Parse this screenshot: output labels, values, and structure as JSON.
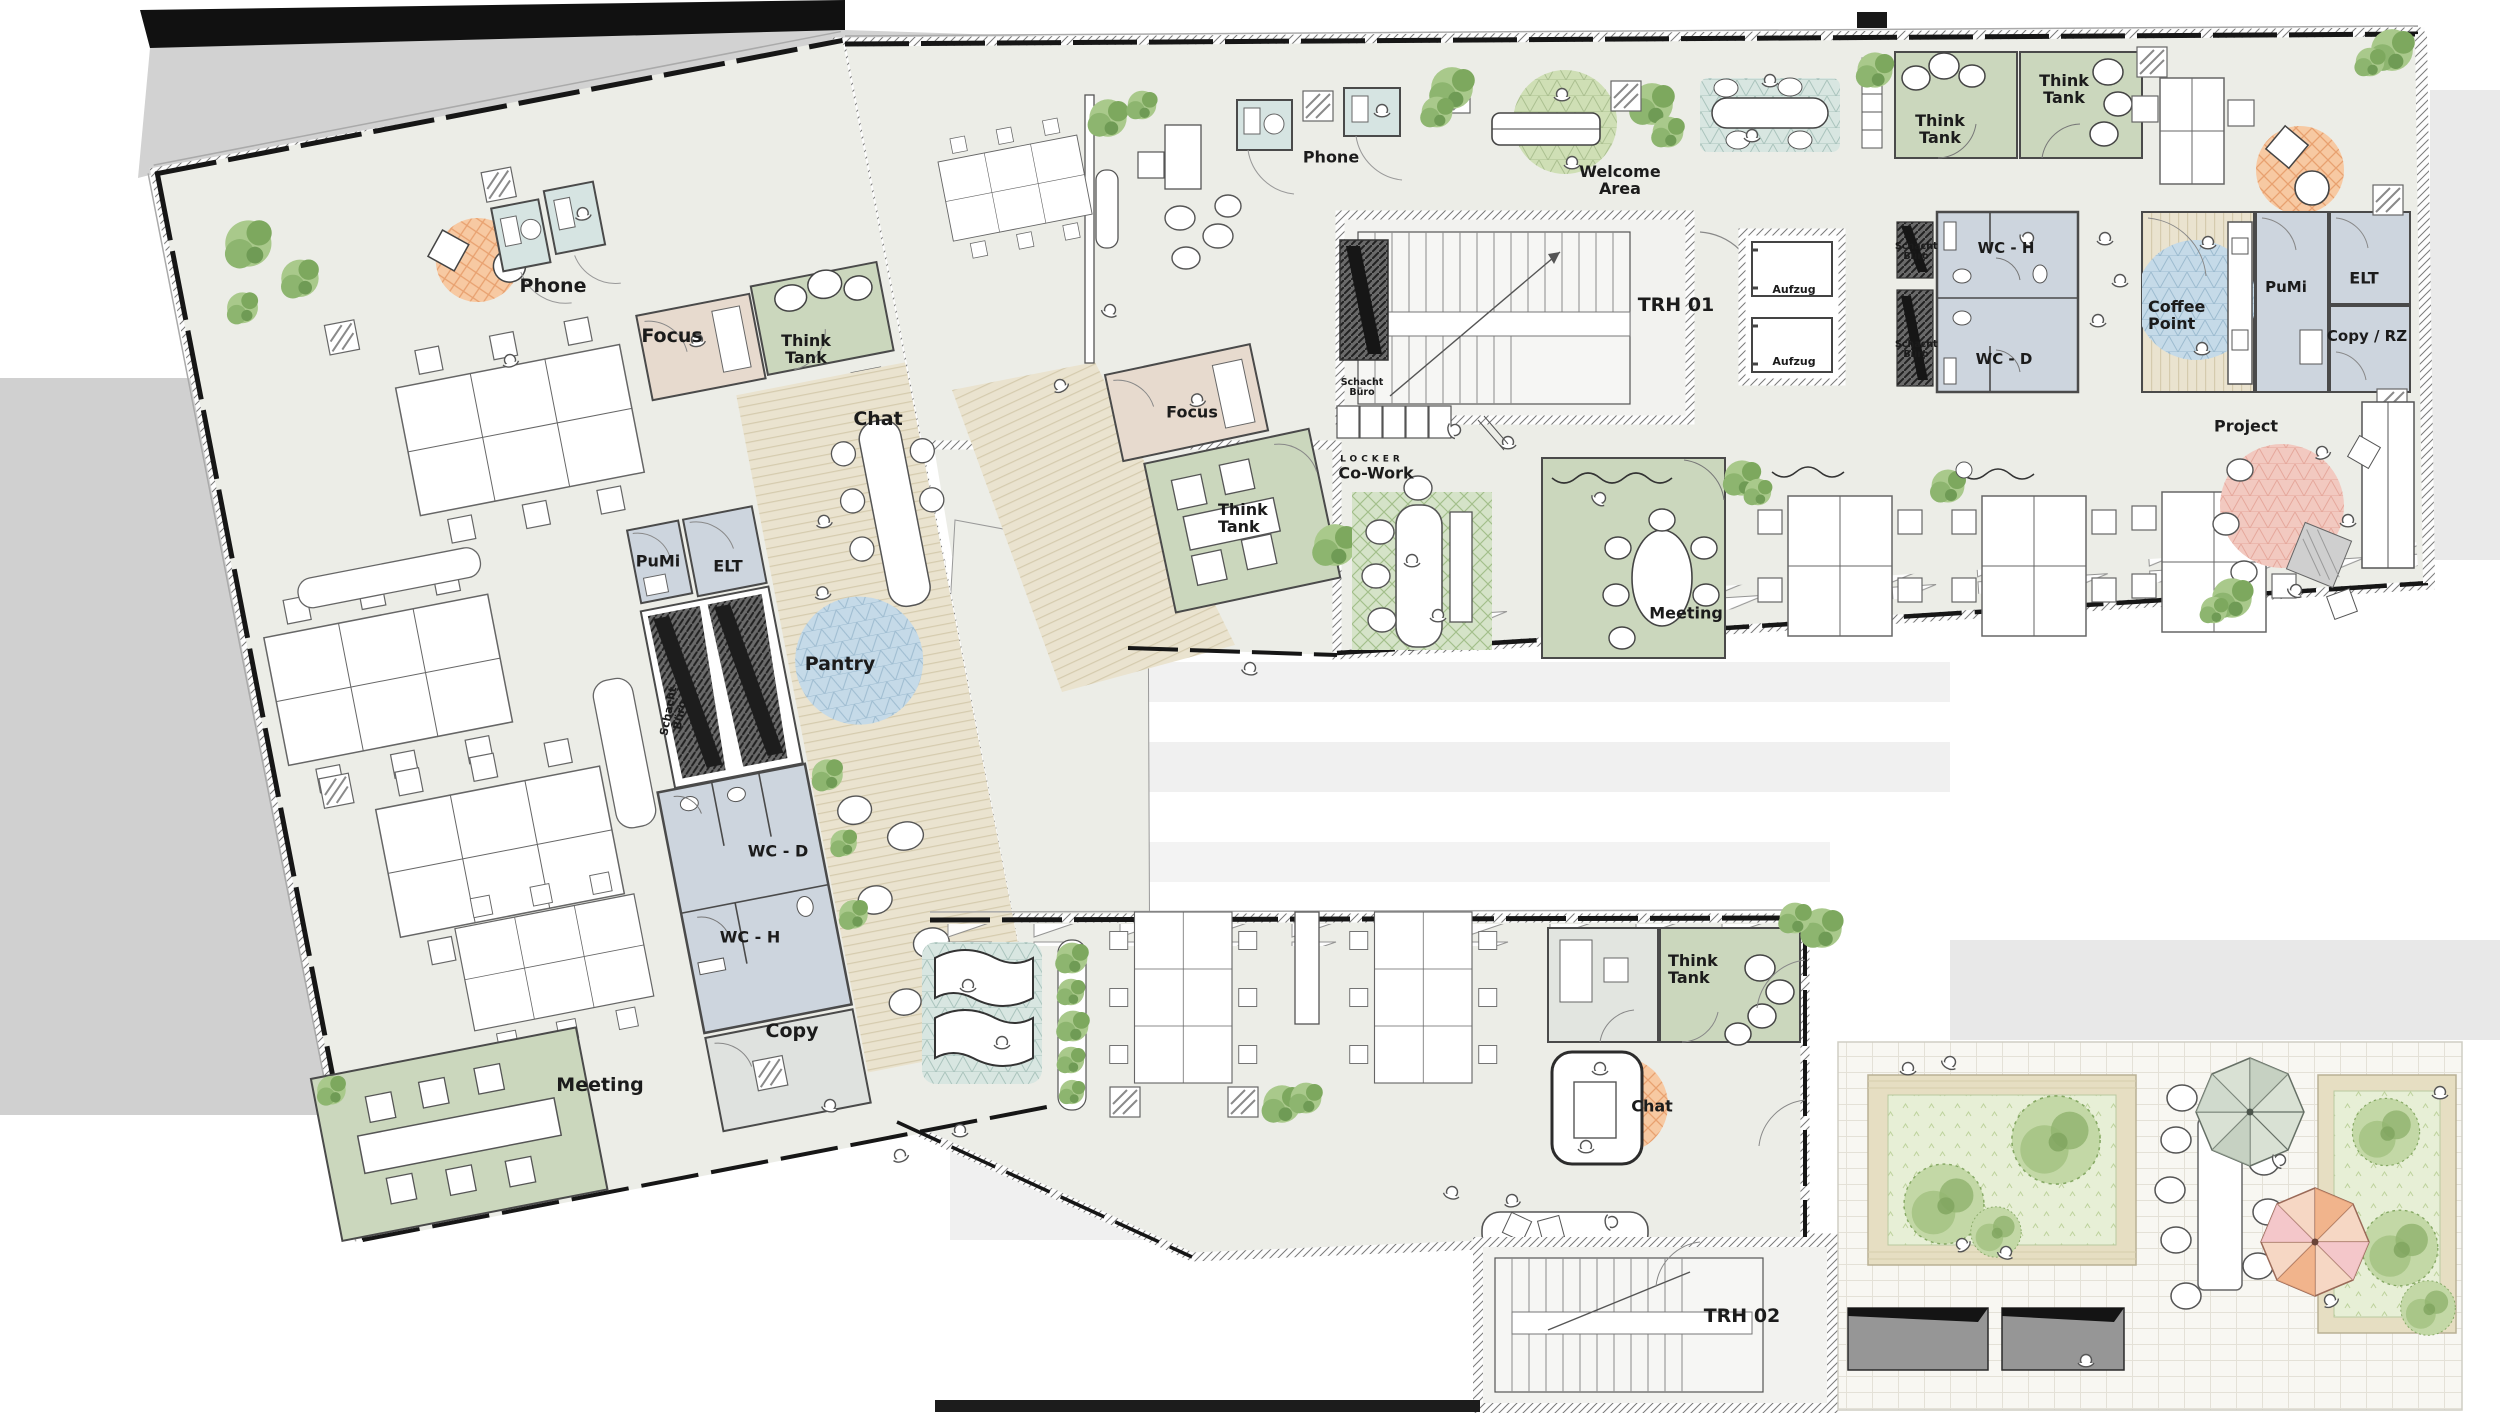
{
  "document": {
    "type": "architectural-floor-plan",
    "floor_features": [
      "open office wings",
      "meeting rooms",
      "sanitary core",
      "two stair houses",
      "roof terrace"
    ]
  },
  "palette": {
    "floor": "#ECEDE7",
    "room_green": "#CBD7BD",
    "room_tan": "#E7DACE",
    "room_bluegray": "#CDD5DE",
    "booth_cyan": "#D6E4E2",
    "accent_orange": "#F7C9A2",
    "accent_blue": "#C5DAE8",
    "accent_green": "#CFDFB5",
    "accent_pink": "#F2C9C0",
    "accent_teal": "#D8E6E1",
    "wood": "#EAE3CF",
    "terrace_tile": "#F8F7F2",
    "planter": "#E6DEC2",
    "plant_green": "#9CBF7D",
    "shaft_gray": "#6A6A6A",
    "wall": "#3C3C3C"
  },
  "labels": [
    {
      "id": "phone-left",
      "text": "Phone"
    },
    {
      "id": "focus-left",
      "text": "Focus"
    },
    {
      "id": "think-tank-left",
      "text": "Think Tank"
    },
    {
      "id": "chat-left",
      "text": "Chat"
    },
    {
      "id": "pumi-left",
      "text": "PuMi"
    },
    {
      "id": "elt-left",
      "text": "ELT"
    },
    {
      "id": "pantry",
      "text": "Pantry"
    },
    {
      "id": "schacht-buero-left",
      "text": "Schacht Büro"
    },
    {
      "id": "wc-d-left",
      "text": "WC - D"
    },
    {
      "id": "wc-h-left",
      "text": "WC - H"
    },
    {
      "id": "copy-left",
      "text": "Copy"
    },
    {
      "id": "meeting-left",
      "text": "Meeting"
    },
    {
      "id": "phone-top",
      "text": "Phone"
    },
    {
      "id": "welcome-area",
      "text": "Welcome Area"
    },
    {
      "id": "think-tank-top-1",
      "text": "Think Tank"
    },
    {
      "id": "think-tank-top-2",
      "text": "Think Tank"
    },
    {
      "id": "trh-01",
      "text": "TRH 01"
    },
    {
      "id": "aufzug-1",
      "text": "Aufzug"
    },
    {
      "id": "aufzug-2",
      "text": "Aufzug"
    },
    {
      "id": "schacht-buero-trh01",
      "text": "Schacht Büro"
    },
    {
      "id": "locker",
      "text": "LOCKER"
    },
    {
      "id": "schacht-buero-r1",
      "text": "Schacht Büro"
    },
    {
      "id": "schacht-buero-r2",
      "text": "Schacht Büro"
    },
    {
      "id": "wc-h-top",
      "text": "WC - H"
    },
    {
      "id": "wc-d-top",
      "text": "WC - D"
    },
    {
      "id": "coffee-point",
      "text": "Coffee Point"
    },
    {
      "id": "pumi-top",
      "text": "PuMi"
    },
    {
      "id": "elt-top",
      "text": "ELT"
    },
    {
      "id": "copy-rz",
      "text": "Copy / RZ"
    },
    {
      "id": "project",
      "text": "Project"
    },
    {
      "id": "co-work",
      "text": "Co-Work"
    },
    {
      "id": "meeting-top",
      "text": "Meeting"
    },
    {
      "id": "focus-center",
      "text": "Focus"
    },
    {
      "id": "think-tank-center",
      "text": "Think Tank"
    },
    {
      "id": "think-tank-bottom",
      "text": "Think Tank"
    },
    {
      "id": "chat-bottom",
      "text": "Chat"
    },
    {
      "id": "trh-02",
      "text": "TRH 02"
    }
  ]
}
